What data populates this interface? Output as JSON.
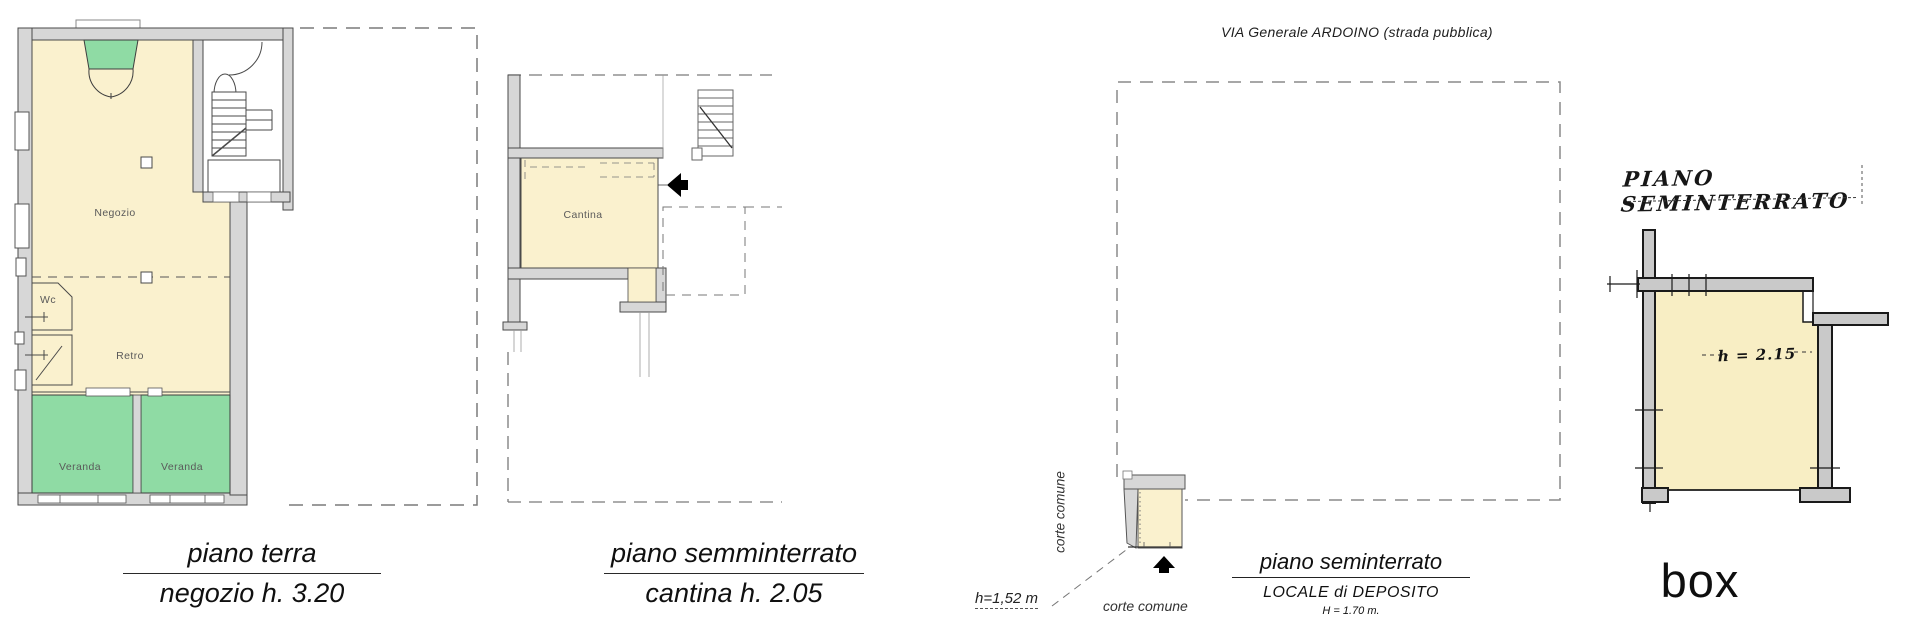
{
  "plans": {
    "piano_terra": {
      "caption_title": "piano terra",
      "caption_subtitle": "negozio h. 3.20",
      "rooms": {
        "negozio": "Negozio",
        "wc": "Wc",
        "retro": "Retro",
        "veranda_left": "Veranda",
        "veranda_right": "Veranda"
      }
    },
    "piano_semminterrato": {
      "caption_title": "piano semminterrato",
      "caption_subtitle": "cantina h. 2.05",
      "rooms": {
        "cantina": "Cantina"
      }
    },
    "locale_deposito": {
      "street_label": "VIA Generale ARDOINO (strada pubblica)",
      "corte_comune_left": "corte comune",
      "corte_comune_bottom": "corte comune",
      "height_label": "h=1,52 m",
      "caption_title": "piano seminterrato",
      "caption_subtitle": "LOCALE di DEPOSITO",
      "caption_note": "H = 1.70 m."
    },
    "box": {
      "plan_title": "PIANO SEMINTERRATO",
      "height_label": "h = 2.15",
      "caption_title": "box"
    }
  },
  "colors": {
    "room_fill": "#FAF1CE",
    "veranda_fill": "#8FDBA4",
    "wall_fill": "#D7D7D7",
    "drawing_line": "#4A4A4A",
    "scan_line": "#1A1A1A",
    "dashed_boundary": "#7A7A7A"
  }
}
